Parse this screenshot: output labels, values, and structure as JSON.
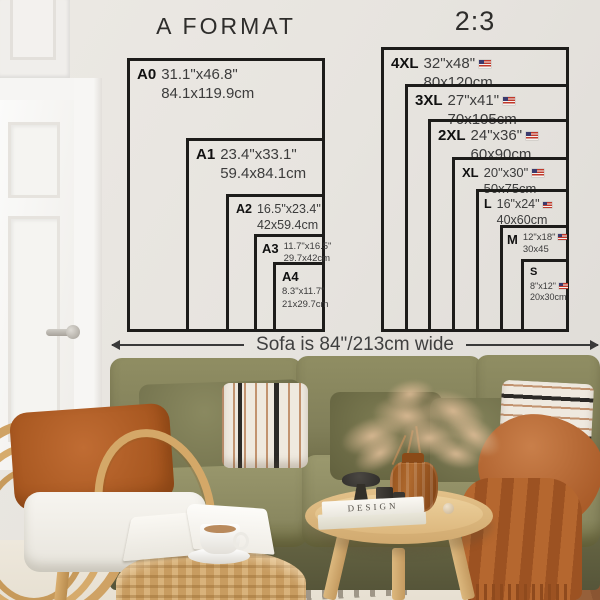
{
  "diagrams": [
    {
      "title": "A FORMAT",
      "sizes": [
        {
          "code": "A0",
          "inches": "31.1\"x46.8\"",
          "cm": "84.1x119.9cm"
        },
        {
          "code": "A1",
          "inches": "23.4\"x33.1\"",
          "cm": "59.4x84.1cm"
        },
        {
          "code": "A2",
          "inches": "16.5\"x23.4\"",
          "cm": "42x59.4cm"
        },
        {
          "code": "A3",
          "inches": "11.7\"x16.5\"",
          "cm": "29.7x42cm"
        },
        {
          "code": "A4",
          "inches": "8.3\"x11.7\"",
          "cm": "21x29.7cm"
        }
      ]
    },
    {
      "title": "2:3",
      "sizes": [
        {
          "code": "4XL",
          "inches": "32\"x48\"",
          "cm": "80x120cm",
          "flag": "us"
        },
        {
          "code": "3XL",
          "inches": "27\"x41\"",
          "cm": "70x105cm",
          "flag": "us"
        },
        {
          "code": "2XL",
          "inches": "24\"x36\"",
          "cm": "60x90cm",
          "flag": "us"
        },
        {
          "code": "XL",
          "inches": "20\"x30\"",
          "cm": "50x75cm",
          "flag": "us"
        },
        {
          "code": "L",
          "inches": "16\"x24\"",
          "cm": "40x60cm",
          "flag": "us"
        },
        {
          "code": "M",
          "inches": "12\"x18\"",
          "cm": "30x45",
          "flag": "us"
        },
        {
          "code": "S",
          "inches": "8\"x12\"",
          "cm": "20x30cm",
          "flag": "us"
        }
      ]
    }
  ],
  "sofa_note": {
    "label": "Sofa is 84\"/213cm wide"
  },
  "scene": {
    "book_title": "DESIGN"
  },
  "colors": {
    "wall": "#e7e4df",
    "diagram_line": "#1d1c1a",
    "text": "#3c3c3c",
    "sofa_olive": "#8b8a60",
    "throw_rust": "#b5672f",
    "rattan": "#cfa264",
    "rug": "#ebe5d8",
    "wood_floor": "#96603a"
  }
}
